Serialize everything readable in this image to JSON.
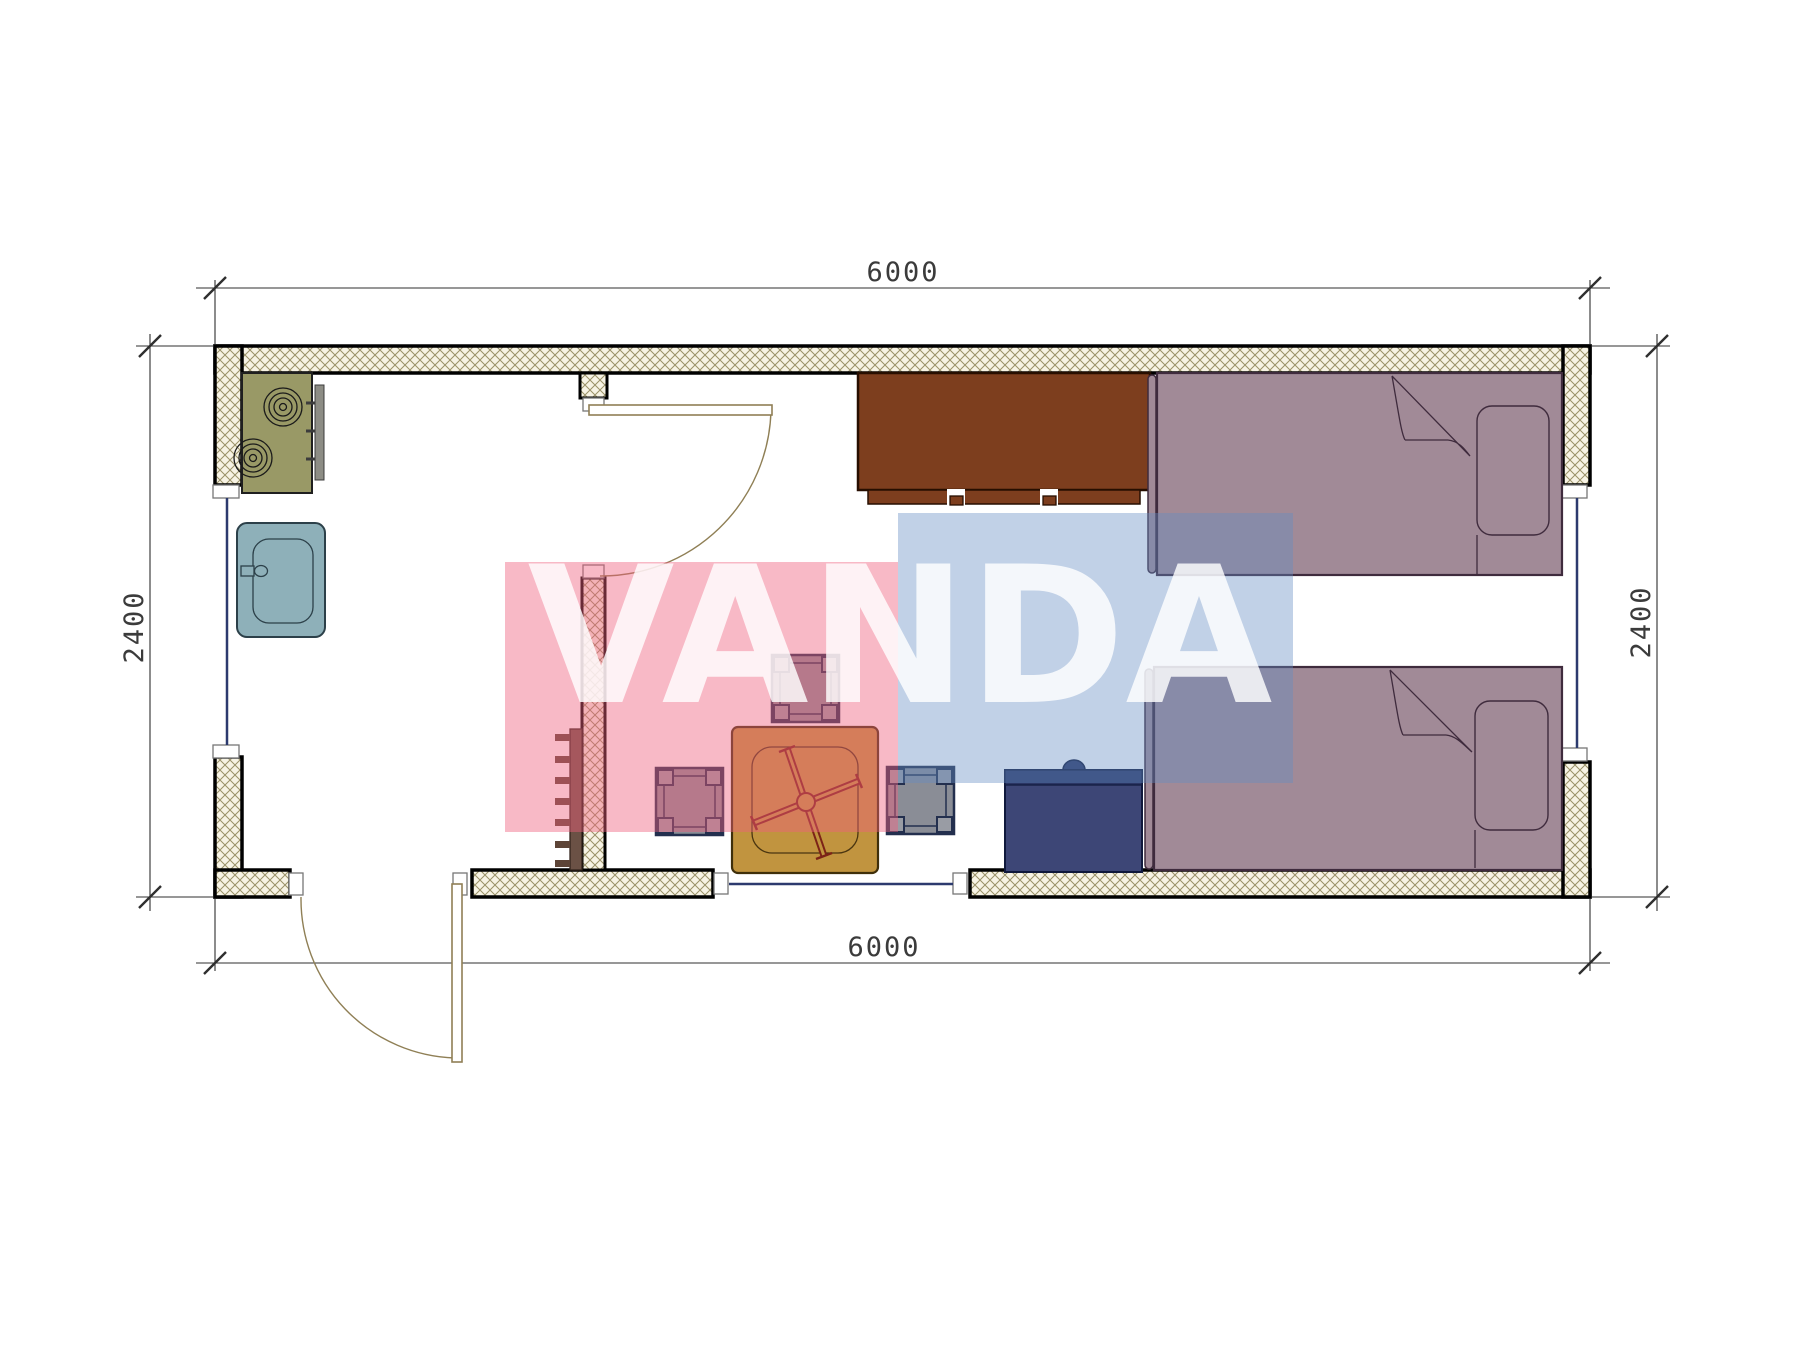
{
  "page": {
    "type": "architectural-floor-plan",
    "background": "#ffffff"
  },
  "dimensions": {
    "top": "6000",
    "bottom": "6000",
    "left": "2400",
    "right": "2400"
  },
  "watermark": {
    "text": "VANDA",
    "red_overlay_color": "#f8bac7",
    "blue_overlay_color": "#c4d3e8"
  },
  "plan_symbols": {
    "openings": [
      "entrance-door",
      "interior-door",
      "window-left",
      "window-right",
      "window-bottom"
    ],
    "furniture": [
      "stove-cooktop",
      "sink",
      "kitchen-cabinet",
      "folding-table",
      "stool",
      "stool",
      "stool",
      "radiator",
      "nightstand",
      "single-bed-top",
      "single-bed-bottom"
    ]
  },
  "colors": {
    "wall_fill": "#f7f3e4",
    "wall_hatch_line": "#9a9168",
    "bed": "#a18a97",
    "cabinet": "#7d3e1e",
    "stove": "#999966",
    "sink": "#8eb0b9",
    "table": "#c1943f",
    "stool": "#8a8d96",
    "nightstand": "#3d4676",
    "radiator": "#6b5145",
    "window_line": "#2c3a6e",
    "door_line": "#8f7f55",
    "dimension_line": "#2f2f2f"
  }
}
